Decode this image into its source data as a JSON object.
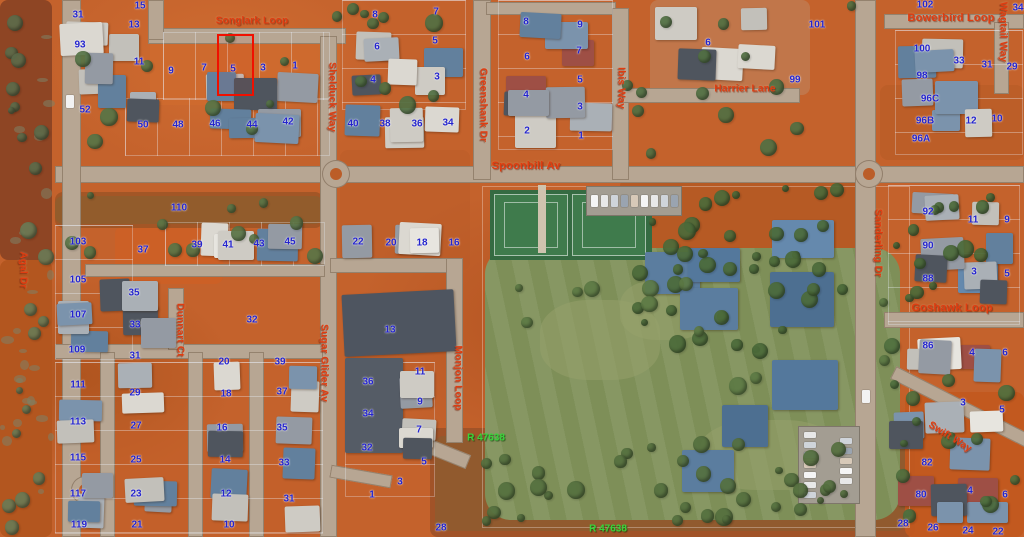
{
  "map": {
    "colors": {
      "street_label": "#e03c10",
      "lot_label": "#2424cd",
      "reserve_label": "#38d53a",
      "highlight": "#f01000"
    },
    "streets": [
      {
        "t": "Songlark Loop",
        "x": 252,
        "y": 21,
        "r": 0
      },
      {
        "t": "Shelduck Way",
        "x": 332,
        "y": 97,
        "r": 90
      },
      {
        "t": "Greenshank Dr",
        "x": 483,
        "y": 105,
        "r": 90
      },
      {
        "t": "Spoonbill Av",
        "x": 526,
        "y": 166,
        "r": 0,
        "s": 11
      },
      {
        "t": "Ibis Way",
        "x": 621,
        "y": 88,
        "r": 90
      },
      {
        "t": "Harrier Lane",
        "x": 745,
        "y": 89,
        "r": 0
      },
      {
        "t": "Bowerbird Loop",
        "x": 951,
        "y": 18,
        "r": 0,
        "s": 11
      },
      {
        "t": "Wagtail Way",
        "x": 1003,
        "y": 32,
        "r": 90
      },
      {
        "t": "Agal Dr",
        "x": 23,
        "y": 270,
        "r": 90
      },
      {
        "t": "Dunnart Ct",
        "x": 180,
        "y": 330,
        "r": 90
      },
      {
        "t": "Sugar Glider Av",
        "x": 324,
        "y": 363,
        "r": 90
      },
      {
        "t": "Monjon Loop",
        "x": 458,
        "y": 378,
        "r": 90
      },
      {
        "t": "Sanderling Dr",
        "x": 878,
        "y": 243,
        "r": 90
      },
      {
        "t": "Goshawk Loop",
        "x": 952,
        "y": 308,
        "r": 0,
        "s": 11
      },
      {
        "t": "Swift Way",
        "x": 950,
        "y": 437,
        "r": 32
      }
    ],
    "reserves": [
      {
        "t": "R 47638",
        "x": 486,
        "y": 438
      },
      {
        "t": "R 47638",
        "x": 608,
        "y": 529
      }
    ],
    "highlighted_parcel": {
      "lot": "5",
      "x": 217,
      "y": 34,
      "w": 33,
      "h": 58
    },
    "lots": [
      {
        "t": "31",
        "x": 78,
        "y": 15
      },
      {
        "t": "15",
        "x": 140,
        "y": 6
      },
      {
        "t": "13",
        "x": 134,
        "y": 25
      },
      {
        "t": "93",
        "x": 80,
        "y": 45
      },
      {
        "t": "11",
        "x": 139,
        "y": 62
      },
      {
        "t": "9",
        "x": 171,
        "y": 71
      },
      {
        "t": "7",
        "x": 204,
        "y": 68
      },
      {
        "t": "5",
        "x": 233,
        "y": 69
      },
      {
        "t": "3",
        "x": 263,
        "y": 68
      },
      {
        "t": "1",
        "x": 295,
        "y": 66
      },
      {
        "t": "52",
        "x": 85,
        "y": 110
      },
      {
        "t": "50",
        "x": 143,
        "y": 125
      },
      {
        "t": "48",
        "x": 178,
        "y": 125
      },
      {
        "t": "46",
        "x": 215,
        "y": 124
      },
      {
        "t": "44",
        "x": 252,
        "y": 125
      },
      {
        "t": "42",
        "x": 288,
        "y": 122
      },
      {
        "t": "8",
        "x": 375,
        "y": 15
      },
      {
        "t": "7",
        "x": 436,
        "y": 12
      },
      {
        "t": "6",
        "x": 377,
        "y": 47
      },
      {
        "t": "5",
        "x": 435,
        "y": 41
      },
      {
        "t": "4",
        "x": 373,
        "y": 80
      },
      {
        "t": "3",
        "x": 437,
        "y": 77
      },
      {
        "t": "40",
        "x": 353,
        "y": 124
      },
      {
        "t": "38",
        "x": 385,
        "y": 124
      },
      {
        "t": "36",
        "x": 417,
        "y": 124
      },
      {
        "t": "34",
        "x": 448,
        "y": 123
      },
      {
        "t": "8",
        "x": 526,
        "y": 22
      },
      {
        "t": "9",
        "x": 580,
        "y": 25
      },
      {
        "t": "6",
        "x": 527,
        "y": 57
      },
      {
        "t": "7",
        "x": 579,
        "y": 51
      },
      {
        "t": "4",
        "x": 526,
        "y": 95
      },
      {
        "t": "5",
        "x": 580,
        "y": 80
      },
      {
        "t": "2",
        "x": 527,
        "y": 131
      },
      {
        "t": "3",
        "x": 580,
        "y": 107
      },
      {
        "t": "1",
        "x": 581,
        "y": 136
      },
      {
        "t": "6",
        "x": 708,
        "y": 43
      },
      {
        "t": "101",
        "x": 817,
        "y": 25
      },
      {
        "t": "99",
        "x": 795,
        "y": 80
      },
      {
        "t": "102",
        "x": 925,
        "y": 5
      },
      {
        "t": "34",
        "x": 1018,
        "y": 8
      },
      {
        "t": "100",
        "x": 922,
        "y": 49
      },
      {
        "t": "33",
        "x": 959,
        "y": 61
      },
      {
        "t": "31",
        "x": 987,
        "y": 65
      },
      {
        "t": "29",
        "x": 1012,
        "y": 67
      },
      {
        "t": "98",
        "x": 922,
        "y": 76
      },
      {
        "t": "96C",
        "x": 930,
        "y": 99
      },
      {
        "t": "96B",
        "x": 925,
        "y": 121
      },
      {
        "t": "96A",
        "x": 921,
        "y": 139
      },
      {
        "t": "12",
        "x": 971,
        "y": 121
      },
      {
        "t": "10",
        "x": 997,
        "y": 119
      },
      {
        "t": "110",
        "x": 179,
        "y": 208
      },
      {
        "t": "103",
        "x": 78,
        "y": 242
      },
      {
        "t": "37",
        "x": 143,
        "y": 250
      },
      {
        "t": "39",
        "x": 197,
        "y": 245
      },
      {
        "t": "41",
        "x": 228,
        "y": 245
      },
      {
        "t": "43",
        "x": 259,
        "y": 244
      },
      {
        "t": "45",
        "x": 290,
        "y": 242
      },
      {
        "t": "105",
        "x": 78,
        "y": 280
      },
      {
        "t": "35",
        "x": 134,
        "y": 293
      },
      {
        "t": "107",
        "x": 78,
        "y": 315
      },
      {
        "t": "33",
        "x": 135,
        "y": 325
      },
      {
        "t": "32",
        "x": 252,
        "y": 320
      },
      {
        "t": "109",
        "x": 77,
        "y": 350
      },
      {
        "t": "31",
        "x": 135,
        "y": 356
      },
      {
        "t": "22",
        "x": 358,
        "y": 242
      },
      {
        "t": "20",
        "x": 391,
        "y": 243
      },
      {
        "t": "18",
        "x": 422,
        "y": 243
      },
      {
        "t": "16",
        "x": 454,
        "y": 243
      },
      {
        "t": "13",
        "x": 390,
        "y": 330
      },
      {
        "t": "111",
        "x": 78,
        "y": 385
      },
      {
        "t": "29",
        "x": 135,
        "y": 393
      },
      {
        "t": "20",
        "x": 224,
        "y": 362
      },
      {
        "t": "39",
        "x": 280,
        "y": 362
      },
      {
        "t": "18",
        "x": 226,
        "y": 394
      },
      {
        "t": "37",
        "x": 282,
        "y": 392
      },
      {
        "t": "113",
        "x": 78,
        "y": 422
      },
      {
        "t": "27",
        "x": 136,
        "y": 426
      },
      {
        "t": "16",
        "x": 222,
        "y": 428
      },
      {
        "t": "35",
        "x": 282,
        "y": 428
      },
      {
        "t": "115",
        "x": 78,
        "y": 458
      },
      {
        "t": "25",
        "x": 136,
        "y": 460
      },
      {
        "t": "14",
        "x": 225,
        "y": 460
      },
      {
        "t": "33",
        "x": 284,
        "y": 463
      },
      {
        "t": "117",
        "x": 78,
        "y": 494
      },
      {
        "t": "23",
        "x": 136,
        "y": 494
      },
      {
        "t": "12",
        "x": 226,
        "y": 494
      },
      {
        "t": "31",
        "x": 289,
        "y": 499
      },
      {
        "t": "119",
        "x": 79,
        "y": 525
      },
      {
        "t": "21",
        "x": 137,
        "y": 525
      },
      {
        "t": "10",
        "x": 229,
        "y": 525
      },
      {
        "t": "36",
        "x": 368,
        "y": 382
      },
      {
        "t": "11",
        "x": 420,
        "y": 372
      },
      {
        "t": "34",
        "x": 368,
        "y": 414
      },
      {
        "t": "9",
        "x": 420,
        "y": 402
      },
      {
        "t": "7",
        "x": 419,
        "y": 430
      },
      {
        "t": "32",
        "x": 367,
        "y": 448
      },
      {
        "t": "5",
        "x": 424,
        "y": 462
      },
      {
        "t": "3",
        "x": 400,
        "y": 482
      },
      {
        "t": "1",
        "x": 372,
        "y": 495
      },
      {
        "t": "28",
        "x": 441,
        "y": 528
      },
      {
        "t": "92",
        "x": 928,
        "y": 212
      },
      {
        "t": "11",
        "x": 973,
        "y": 220
      },
      {
        "t": "9",
        "x": 1007,
        "y": 220
      },
      {
        "t": "90",
        "x": 928,
        "y": 246
      },
      {
        "t": "3",
        "x": 974,
        "y": 272
      },
      {
        "t": "5",
        "x": 1007,
        "y": 274
      },
      {
        "t": "88",
        "x": 928,
        "y": 279
      },
      {
        "t": "86",
        "x": 928,
        "y": 346
      },
      {
        "t": "4",
        "x": 972,
        "y": 353
      },
      {
        "t": "6",
        "x": 1005,
        "y": 353
      },
      {
        "t": "3",
        "x": 963,
        "y": 403
      },
      {
        "t": "5",
        "x": 1002,
        "y": 410
      },
      {
        "t": "82",
        "x": 927,
        "y": 463
      },
      {
        "t": "80",
        "x": 921,
        "y": 495
      },
      {
        "t": "4",
        "x": 970,
        "y": 491
      },
      {
        "t": "6",
        "x": 1005,
        "y": 495
      },
      {
        "t": "28",
        "x": 903,
        "y": 524
      },
      {
        "t": "26",
        "x": 933,
        "y": 528
      },
      {
        "t": "24",
        "x": 968,
        "y": 531
      },
      {
        "t": "22",
        "x": 998,
        "y": 532
      }
    ]
  }
}
